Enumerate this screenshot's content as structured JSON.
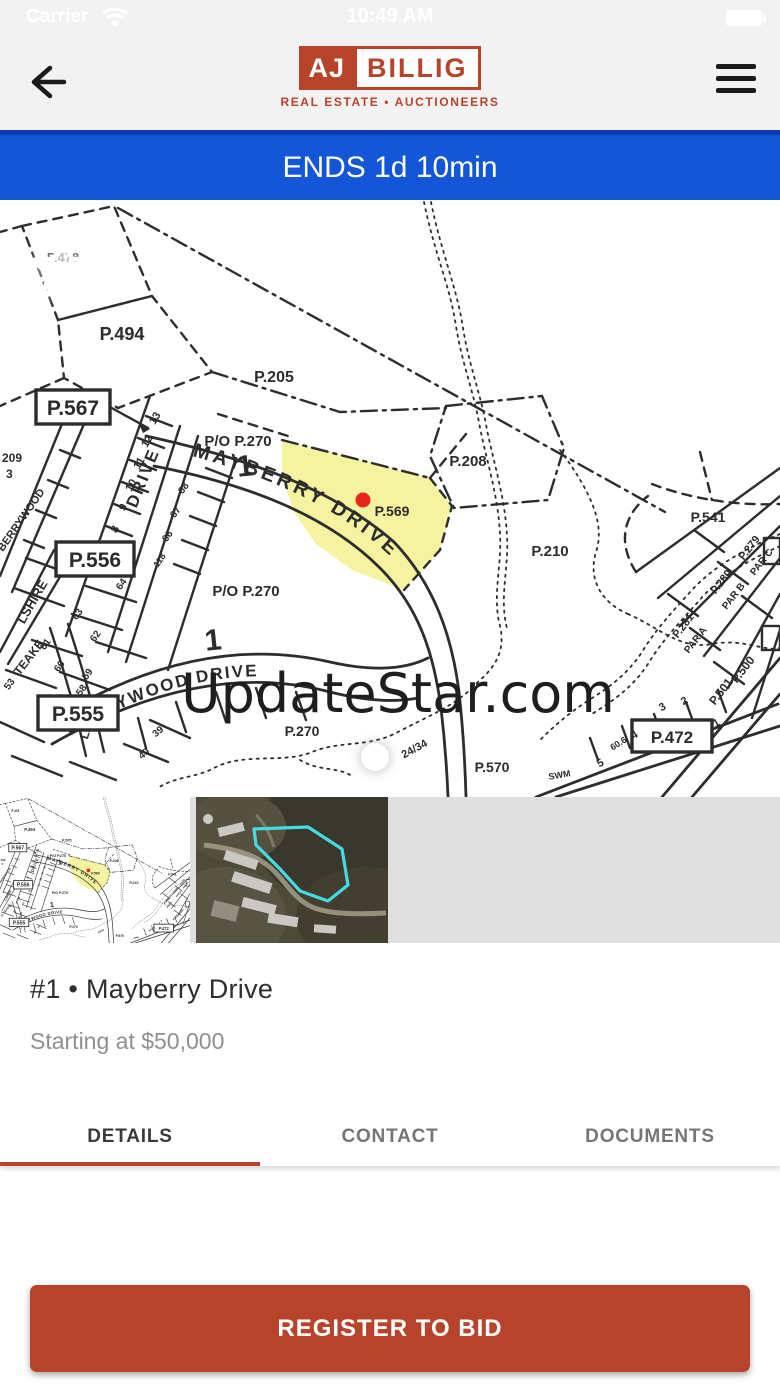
{
  "status_bar": {
    "carrier": "Carrier",
    "time": "10:49 AM"
  },
  "header": {
    "logo_aj": "AJ",
    "logo_billig": "BILLIG",
    "logo_tagline": "REAL ESTATE • AUCTIONEERS"
  },
  "banner": {
    "text": "ENDS 1d 10min"
  },
  "map": {
    "watermark": "UpdateStar.com",
    "road_labels": {
      "mayberry": "MAYBERRY DRIVE",
      "berrywood_drive": "BERRYWOOD DRIVE",
      "berrywood": "BERRYWOOD",
      "drive": "DRIVE",
      "lshire": "LSHIRE",
      "teake": "TEAKE",
      "lane": "LANE"
    },
    "parcel_labels": {
      "p478": "P.478",
      "p494": "P.494",
      "p205": "P.205",
      "p567": "P.567",
      "p209": "209",
      "p209_3": "3",
      "po270_a": "P/O P.270",
      "po270_b": "P/O P.270",
      "p208": "P.208",
      "p569": "P.569",
      "p210": "P.210",
      "p270": "P.270",
      "p2434": "24/34",
      "p570": "P.570",
      "p541": "P.541",
      "p556": "P.556",
      "p555": "P.555",
      "p472": "P.472",
      "p279": "P.279",
      "par_c": "PAR C",
      "p280": "P.280",
      "par_b": "PAR B",
      "p281": "P.281",
      "par_a": "PAR A",
      "p500": "P.500",
      "p501": "P.501",
      "swm": "SWM"
    },
    "lot_numbers": {
      "n13": "13",
      "n12": "12",
      "n11": "11",
      "n10": "10",
      "n9": "9",
      "n8": "8",
      "n68": "68",
      "n67": "67",
      "n66": "66",
      "n118": "118",
      "n64": "64",
      "n63": "63",
      "n62": "62",
      "n61": "61",
      "n60": "60",
      "n59": "59",
      "n58": "58",
      "n53": "53",
      "n39": "39",
      "n40": "40",
      "big1_a": "1",
      "big1_b": "1",
      "r1": "1",
      "r2": "2",
      "r3": "3",
      "r4": "4",
      "r5": "5",
      "n606": "60.6"
    }
  },
  "listing": {
    "title": "#1 • Mayberry Drive",
    "subtitle": "Starting at $50,000"
  },
  "tabs": [
    {
      "label": "DETAILS",
      "active": true
    },
    {
      "label": "CONTACT",
      "active": false
    },
    {
      "label": "DOCUMENTS",
      "active": false
    }
  ],
  "cta": {
    "label": "REGISTER TO BID"
  },
  "colors": {
    "brand_red": "#b7432a",
    "banner_blue": "#1456d8",
    "parcel_yellow": "#f5f2a0",
    "marker_red": "#e5271d",
    "satellite_outline": "#45dbe4",
    "tab_inactive": "#757575",
    "subtitle_gray": "#8f8f8f"
  }
}
